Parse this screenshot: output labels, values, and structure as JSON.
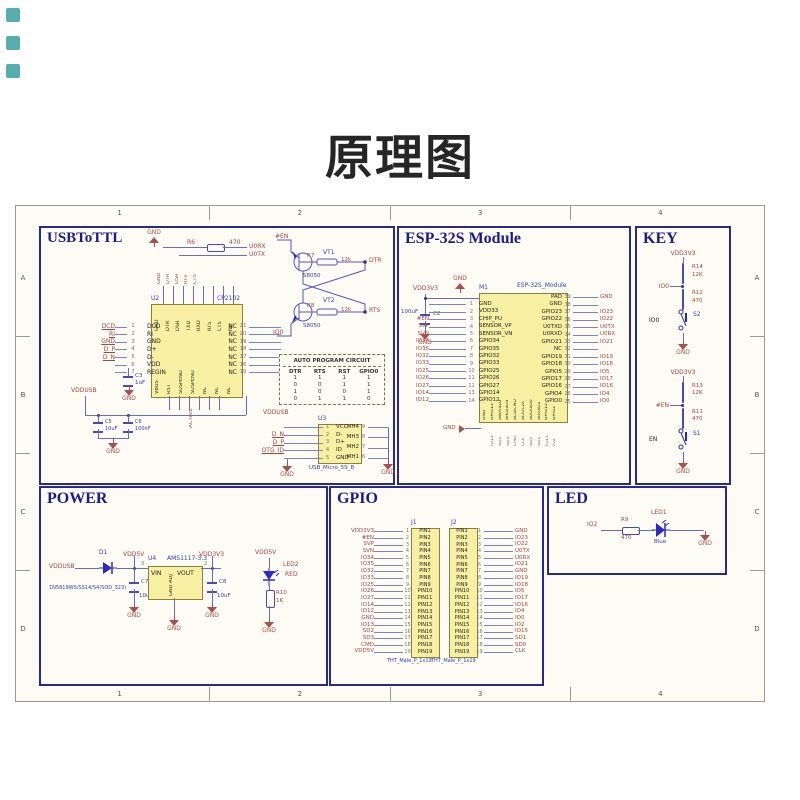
{
  "title": "原理图",
  "frame": {
    "cols": [
      "1",
      "2",
      "3",
      "4"
    ],
    "rows": [
      "A",
      "B",
      "C",
      "D"
    ]
  },
  "labels": {
    "gnd": "GND",
    "vdd3v3": "VDD3V3",
    "vdd5v": "VDD5V",
    "vddusb": "VDDUSB"
  },
  "colors": {
    "accent": "#28288e",
    "chip": "#f7f0a3",
    "net": "#a34444",
    "wire": "#6a6abf"
  },
  "usb": {
    "title": "USBToTTL",
    "gnd_flag": "GND",
    "r6": {
      "ref": "R6",
      "val": "470"
    },
    "u0rx": "U0RX",
    "u0tx": "U0TX",
    "u2": {
      "refdes": "U2",
      "part": "CP2102",
      "top": [
        "GND",
        "DTR",
        "DSR",
        "TXD",
        "RXD",
        "RTS",
        "CTS",
        "NC"
      ],
      "top_nets": [
        "GND",
        "DTR",
        "DSR",
        "RTS",
        "CTS"
      ],
      "left": [
        {
          "n": "1",
          "name": "DCD",
          "net": "DCD"
        },
        {
          "n": "2",
          "name": "RI",
          "net": "RI"
        },
        {
          "n": "3",
          "name": "GND",
          "net": "GND"
        },
        {
          "n": "4",
          "name": "D+",
          "net": "D_P"
        },
        {
          "n": "5",
          "name": "D-",
          "net": "D_N"
        },
        {
          "n": "6",
          "name": "VDD",
          "net": ""
        },
        {
          "n": "7",
          "name": "REGIN",
          "net": ""
        }
      ],
      "right": [
        {
          "n": "21",
          "name": "NC"
        },
        {
          "n": "20",
          "name": "NC"
        },
        {
          "n": "19",
          "name": "NC"
        },
        {
          "n": "18",
          "name": "NC"
        },
        {
          "n": "17",
          "name": "NC"
        },
        {
          "n": "16",
          "name": "NC"
        },
        {
          "n": "15",
          "name": "NC"
        }
      ],
      "bottom": [
        "VBUS",
        "RST",
        "SUSPEND",
        "SUSPEND",
        "NC",
        "NC",
        "NC"
      ]
    },
    "c3": {
      "ref": "C3",
      "val": "1uF"
    },
    "active": "ACTIVE",
    "c5": {
      "ref": "C5",
      "val": "10uF"
    },
    "c6": {
      "ref": "C6",
      "val": "100nF"
    },
    "prog": {
      "en": "#EN",
      "io0": "IO0",
      "vt1": "VT1",
      "vt2": "VT2",
      "part1": "S8050",
      "part2": "S8050",
      "r7": {
        "ref": "R7",
        "val": "12k"
      },
      "r8": {
        "ref": "R8",
        "val": "12k"
      },
      "dtr": "DTR",
      "rts": "RTS"
    },
    "table": {
      "title": "AUTO PROGRAM CIRCUIT",
      "headers": [
        "DTR",
        "RTS",
        "RST",
        "GPIO0"
      ],
      "cells": [
        "1",
        "1",
        "1",
        "1",
        "0",
        "0",
        "1",
        "1",
        "1",
        "0",
        "0",
        "1",
        "0",
        "1",
        "1",
        "0"
      ]
    },
    "u3": {
      "refdes": "U3",
      "part": "USB_Micro_5S_B",
      "vcc_net": "VDDUSB",
      "left": [
        {
          "n": "1",
          "name": "VCC",
          "net": ""
        },
        {
          "n": "2",
          "name": "D-",
          "net": "D_N"
        },
        {
          "n": "3",
          "name": "D+",
          "net": "D_P"
        },
        {
          "n": "4",
          "name": "ID",
          "net": "OTG_ID"
        },
        {
          "n": "5",
          "name": "GND",
          "net": ""
        }
      ],
      "right": [
        {
          "n": "9",
          "name": "MH4"
        },
        {
          "n": "8",
          "name": "MH3"
        },
        {
          "n": "7",
          "name": "MH2"
        },
        {
          "n": "6",
          "name": "MH1"
        }
      ]
    }
  },
  "esp": {
    "title": "ESP-32S Module",
    "refdes": "M1",
    "part": "ESP-32S_Module",
    "vcc": "VDD3V3",
    "c2": {
      "ref": "C2",
      "val": "100uF"
    },
    "gnd_left": "GND",
    "left": [
      {
        "n": "1",
        "name": "GND",
        "net": ""
      },
      {
        "n": "2",
        "name": "VDD33",
        "net": ""
      },
      {
        "n": "3",
        "name": "CHIP_PU",
        "net": "#EN"
      },
      {
        "n": "4",
        "name": "SENSOR_VP",
        "net": "SVP"
      },
      {
        "n": "5",
        "name": "SENSOR_VN",
        "net": "SVN"
      },
      {
        "n": "6",
        "name": "GPIO34",
        "net": "IO34"
      },
      {
        "n": "7",
        "name": "GPIO35",
        "net": "IO35"
      },
      {
        "n": "8",
        "name": "GPIO32",
        "net": "IO32"
      },
      {
        "n": "9",
        "name": "GPIO33",
        "net": "IO33"
      },
      {
        "n": "10",
        "name": "GPIO25",
        "net": "IO25"
      },
      {
        "n": "11",
        "name": "GPIO26",
        "net": "IO26"
      },
      {
        "n": "12",
        "name": "GPIO27",
        "net": "IO27"
      },
      {
        "n": "13",
        "name": "GPIO14",
        "net": "IO14"
      },
      {
        "n": "14",
        "name": "GPIO12",
        "net": "IO12"
      }
    ],
    "right": [
      {
        "n": "39",
        "name": "PAD",
        "net": "GND"
      },
      {
        "n": "38",
        "name": "GND",
        "net": ""
      },
      {
        "n": "37",
        "name": "GPIO23",
        "net": "IO23"
      },
      {
        "n": "36",
        "name": "GPIO22",
        "net": "IO22"
      },
      {
        "n": "35",
        "name": "U0TXD",
        "net": "U0TX"
      },
      {
        "n": "34",
        "name": "U0RXD",
        "net": "U0RX"
      },
      {
        "n": "33",
        "name": "GPIO21",
        "net": "IO21"
      },
      {
        "n": "32",
        "name": "NC",
        "net": ""
      },
      {
        "n": "31",
        "name": "GPIO19",
        "net": "IO19"
      },
      {
        "n": "30",
        "name": "GPIO18",
        "net": "IO18"
      },
      {
        "n": "29",
        "name": "GPIO5",
        "net": "IO5"
      },
      {
        "n": "28",
        "name": "GPIO17",
        "net": "IO17"
      },
      {
        "n": "27",
        "name": "GPIO16",
        "net": "IO16"
      },
      {
        "n": "26",
        "name": "GPIO4",
        "net": "IO4"
      },
      {
        "n": "25",
        "name": "GPIO0",
        "net": "IO0"
      }
    ],
    "bottom": [
      "GND",
      "GPIO13",
      "SWP/SD2",
      "SHD/SD3",
      "SCS/CMD",
      "SCK/CLK",
      "SDO/SD0",
      "SDI/SD1",
      "GPIO15",
      "GPIO2"
    ],
    "bottom_nets": [
      "IO13",
      "SD2",
      "SD3",
      "CMD",
      "CLK",
      "SD0",
      "SD1",
      "IO15",
      "IO2"
    ]
  },
  "key": {
    "title": "KEY",
    "circuits": [
      {
        "vcc": "VDD3V3",
        "r1": "R14",
        "r1v": "12K",
        "net": "IO0",
        "r2": "R12",
        "r2v": "470",
        "swnet": "IO0",
        "sw": "S2",
        "gnd": "GND"
      },
      {
        "vcc": "VDD3V3",
        "r1": "R13",
        "r1v": "12K",
        "net": "#EN",
        "r2": "R11",
        "r2v": "470",
        "swnet": "EN",
        "sw": "S1",
        "gnd": "GND"
      }
    ]
  },
  "power": {
    "title": "POWER",
    "in": "VDDUSB",
    "d1": "D1",
    "d1_part": "1N5819WS/SS14/S4(SOD_323)",
    "v5": "VDD5V",
    "c7": "C7",
    "c7v": "10uF",
    "u4": "U4",
    "u4_part": "AMS1117-3.3",
    "vin": "VIN",
    "vout": "VOUT",
    "gndadj": "GND ADJ",
    "n3": "3",
    "n2": "2",
    "v33": "VDD3V3",
    "c8": "C8",
    "c8v": "10uF",
    "led_v": "VDD5V",
    "led2": "LED2",
    "led2c": "RED",
    "r10": "R10",
    "r10v": "1K"
  },
  "gpio": {
    "title": "GPIO",
    "j1": "J1",
    "j2": "J2",
    "j1_part": "THT_Male_P_1x19",
    "j2_part": "THT_Male_P_1x19",
    "j1_pins": [
      {
        "num": "1",
        "name": "PIN1",
        "net": "VDD3V3"
      },
      {
        "num": "2",
        "name": "PIN2",
        "net": "#EN"
      },
      {
        "num": "3",
        "name": "PIN3",
        "net": "SVP"
      },
      {
        "num": "4",
        "name": "PIN4",
        "net": "SVN"
      },
      {
        "num": "5",
        "name": "PIN5",
        "net": "IO34"
      },
      {
        "num": "6",
        "name": "PIN6",
        "net": "IO35"
      },
      {
        "num": "7",
        "name": "PIN7",
        "net": "IO32"
      },
      {
        "num": "8",
        "name": "PIN8",
        "net": "IO33"
      },
      {
        "num": "9",
        "name": "PIN9",
        "net": "IO25"
      },
      {
        "num": "10",
        "name": "PIN10",
        "net": "IO26"
      },
      {
        "num": "11",
        "name": "PIN11",
        "net": "IO27"
      },
      {
        "num": "12",
        "name": "PIN12",
        "net": "IO14"
      },
      {
        "num": "13",
        "name": "PIN13",
        "net": "IO12"
      },
      {
        "num": "14",
        "name": "PIN14",
        "net": "GND"
      },
      {
        "num": "15",
        "name": "PIN15",
        "net": "IO13"
      },
      {
        "num": "16",
        "name": "PIN16",
        "net": "SD2"
      },
      {
        "num": "17",
        "name": "PIN17",
        "net": "SD3"
      },
      {
        "num": "18",
        "name": "PIN18",
        "net": "CMD"
      },
      {
        "num": "19",
        "name": "PIN19",
        "net": "VDD5V"
      }
    ],
    "j2_pins": [
      {
        "num": "1",
        "name": "PIN1",
        "net": "GND"
      },
      {
        "num": "2",
        "name": "PIN2",
        "net": "IO23"
      },
      {
        "num": "3",
        "name": "PIN3",
        "net": "IO22"
      },
      {
        "num": "4",
        "name": "PIN4",
        "net": "U0TX"
      },
      {
        "num": "5",
        "name": "PIN5",
        "net": "U0RX"
      },
      {
        "num": "6",
        "name": "PIN6",
        "net": "IO21"
      },
      {
        "num": "7",
        "name": "PIN7",
        "net": "GND"
      },
      {
        "num": "8",
        "name": "PIN8",
        "net": "IO19"
      },
      {
        "num": "9",
        "name": "PIN9",
        "net": "IO18"
      },
      {
        "num": "10",
        "name": "PIN10",
        "net": "IO5"
      },
      {
        "num": "11",
        "name": "PIN11",
        "net": "IO17"
      },
      {
        "num": "12",
        "name": "PIN12",
        "net": "IO16"
      },
      {
        "num": "13",
        "name": "PIN13",
        "net": "IO4"
      },
      {
        "num": "14",
        "name": "PIN14",
        "net": "IO0"
      },
      {
        "num": "15",
        "name": "PIN15",
        "net": "IO2"
      },
      {
        "num": "16",
        "name": "PIN16",
        "net": "IO15"
      },
      {
        "num": "17",
        "name": "PIN17",
        "net": "SD1"
      },
      {
        "num": "18",
        "name": "PIN18",
        "net": "SD0"
      },
      {
        "num": "19",
        "name": "PIN19",
        "net": "CLK"
      }
    ]
  },
  "led": {
    "title": "LED",
    "net": "IO2",
    "r9": "R9",
    "r9v": "470",
    "led1": "LED1",
    "color": "Blue",
    "gnd": "GND"
  }
}
